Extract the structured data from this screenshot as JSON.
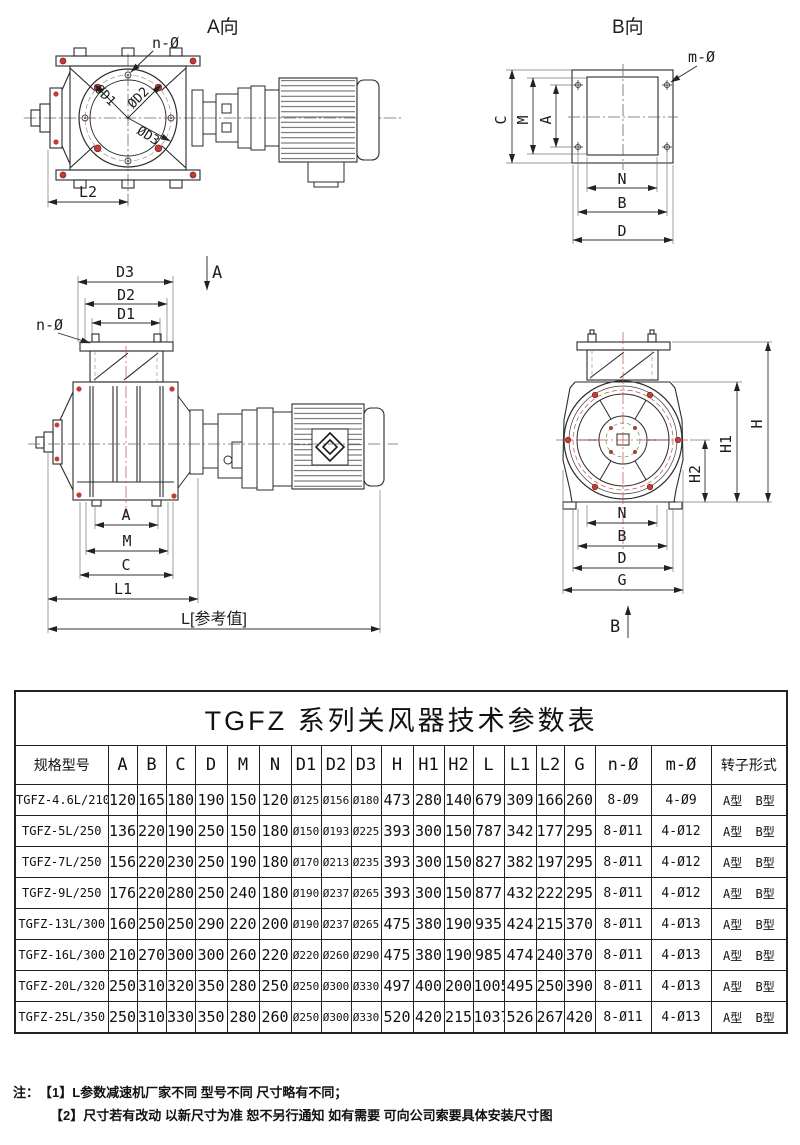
{
  "drawings": {
    "view_a": {
      "title": "A向",
      "n_label": "n-Ø",
      "d1": "ØD1",
      "d2": "ØD2",
      "d3": "ØD3",
      "l2": "L2"
    },
    "view_b": {
      "title": "B向",
      "m_label": "m-Ø",
      "dim_c": "C",
      "dim_m": "M",
      "dim_a": "A",
      "dim_n": "N",
      "dim_b": "B",
      "dim_d": "D"
    },
    "view_side": {
      "dim_d3": "D3",
      "dim_d2": "D2",
      "dim_d1": "D1",
      "section": "A",
      "n_label": "n-Ø",
      "dim_a": "A",
      "dim_m": "M",
      "dim_c": "C",
      "dim_l1": "L1",
      "l_ref": "L[参考值]"
    },
    "view_end": {
      "dim_h": "H",
      "dim_h1": "H1",
      "dim_h2": "H2",
      "dim_n": "N",
      "dim_b": "B",
      "dim_d": "D",
      "dim_g": "G",
      "section": "B"
    }
  },
  "table": {
    "title": "TGFZ 系列关风器技术参数表",
    "headers": [
      "规格型号",
      "A",
      "B",
      "C",
      "D",
      "M",
      "N",
      "D1",
      "D2",
      "D3",
      "H",
      "H1",
      "H2",
      "L",
      "L1",
      "L2",
      "G",
      "n-Ø",
      "m-Ø",
      "转子形式"
    ],
    "rows": [
      [
        "TGFZ-4.6L/210",
        "120",
        "165",
        "180",
        "190",
        "150",
        "120",
        "Ø125",
        "Ø156",
        "Ø180",
        "473",
        "280",
        "140",
        "679",
        "309",
        "166",
        "260",
        "8-Ø9",
        "4-Ø9",
        "A型 B型"
      ],
      [
        "TGFZ-5L/250",
        "136",
        "220",
        "190",
        "250",
        "150",
        "180",
        "Ø150",
        "Ø193",
        "Ø225",
        "393",
        "300",
        "150",
        "787",
        "342",
        "177",
        "295",
        "8-Ø11",
        "4-Ø12",
        "A型 B型"
      ],
      [
        "TGFZ-7L/250",
        "156",
        "220",
        "230",
        "250",
        "190",
        "180",
        "Ø170",
        "Ø213",
        "Ø235",
        "393",
        "300",
        "150",
        "827",
        "382",
        "197",
        "295",
        "8-Ø11",
        "4-Ø12",
        "A型 B型"
      ],
      [
        "TGFZ-9L/250",
        "176",
        "220",
        "280",
        "250",
        "240",
        "180",
        "Ø190",
        "Ø237",
        "Ø265",
        "393",
        "300",
        "150",
        "877",
        "432",
        "222",
        "295",
        "8-Ø11",
        "4-Ø12",
        "A型 B型"
      ],
      [
        "TGFZ-13L/300",
        "160",
        "250",
        "250",
        "290",
        "220",
        "200",
        "Ø190",
        "Ø237",
        "Ø265",
        "475",
        "380",
        "190",
        "935",
        "424",
        "215",
        "370",
        "8-Ø11",
        "4-Ø13",
        "A型 B型"
      ],
      [
        "TGFZ-16L/300",
        "210",
        "270",
        "300",
        "300",
        "260",
        "220",
        "Ø220",
        "Ø260",
        "Ø290",
        "475",
        "380",
        "190",
        "985",
        "474",
        "240",
        "370",
        "8-Ø11",
        "4-Ø13",
        "A型 B型"
      ],
      [
        "TGFZ-20L/320",
        "250",
        "310",
        "320",
        "350",
        "280",
        "250",
        "Ø250",
        "Ø300",
        "Ø330",
        "497",
        "400",
        "200",
        "1005",
        "495",
        "250",
        "390",
        "8-Ø11",
        "4-Ø13",
        "A型 B型"
      ],
      [
        "TGFZ-25L/350",
        "250",
        "310",
        "330",
        "350",
        "280",
        "260",
        "Ø250",
        "Ø300",
        "Ø330",
        "520",
        "420",
        "215",
        "1037",
        "526",
        "267",
        "420",
        "8-Ø11",
        "4-Ø13",
        "A型 B型"
      ]
    ]
  },
  "notes": {
    "prefix": "注：",
    "line1": "【1】L参数减速机厂家不同 型号不同 尺寸略有不同；",
    "line2": "【2】尺寸若有改动 以新尺寸为准 恕不另行通知 如有需要 可向公司索要具体安装尺寸图"
  },
  "colors": {
    "line": "#2b2b2b",
    "accent_red": "#c23b34",
    "accent_green": "#3aa545"
  }
}
